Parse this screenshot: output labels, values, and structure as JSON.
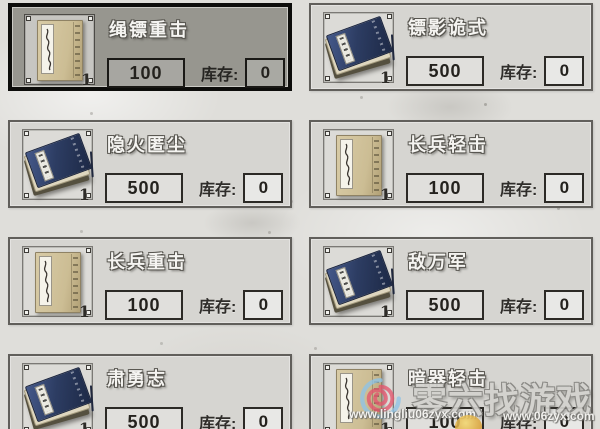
{
  "shop": {
    "stock_label": "库存:",
    "icon_badge": "1",
    "items": [
      {
        "name": "绳镖重击",
        "price": "100",
        "stock": "0",
        "icon": "tan-manual",
        "selected": true
      },
      {
        "name": "镖影诡式",
        "price": "500",
        "stock": "0",
        "icon": "blue-manual-stack",
        "selected": false
      },
      {
        "name": "隐火匿尘",
        "price": "500",
        "stock": "0",
        "icon": "blue-manual-stack",
        "selected": false
      },
      {
        "name": "长兵轻击",
        "price": "100",
        "stock": "0",
        "icon": "tan-manual",
        "selected": false
      },
      {
        "name": "长兵重击",
        "price": "100",
        "stock": "0",
        "icon": "tan-manual",
        "selected": false
      },
      {
        "name": "敌万军",
        "price": "500",
        "stock": "0",
        "icon": "blue-manual-stack",
        "selected": false
      },
      {
        "name": "肃勇志",
        "price": "500",
        "stock": "0",
        "icon": "blue-manual-stack",
        "selected": false
      },
      {
        "name": "暗器轻击",
        "price": "100",
        "stock": "0",
        "icon": "tan-manual",
        "selected": false
      }
    ]
  },
  "watermark": {
    "brand_text": "零六找游戏",
    "url_left": "www.lingliu06zyx.com",
    "url_right": "www.06zyx.com"
  },
  "colors": {
    "page_bg": "#dfdeda",
    "card_bg": "#d6d5d1",
    "selected_card_bg": "#97968f",
    "card_border": "#615f5b",
    "selected_card_border": "#0d0d0b",
    "manual_navy": "#2d3d63",
    "manual_tan": "#ccbd94",
    "watermark_gray": "#d3d2ce"
  }
}
